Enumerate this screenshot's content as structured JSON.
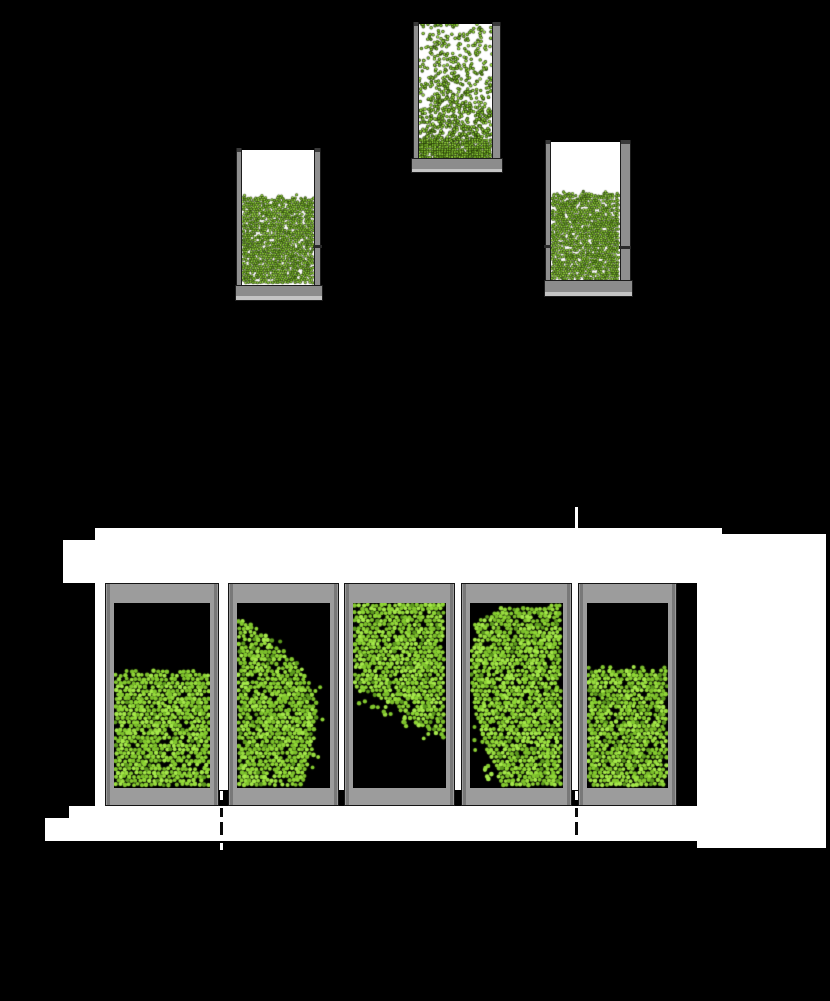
{
  "figure": {
    "background": "#000000",
    "palette": {
      "white": "#ffffff",
      "frame_gray": "#9c9c9c",
      "frame_edge": "#787878",
      "frame_line": "#141414",
      "wall_gray": "#8f8f8f",
      "slab_gray": "#8c8c8c",
      "slab_light": "#c4c4c4",
      "cap_dark": "#3a3a3a",
      "interior_black": "#000000",
      "particle_colors": [
        "#8fd636",
        "#99dd3f",
        "#a5e94a",
        "#83c92f",
        "#7cbf2b"
      ],
      "particle_dark": "#5d9a1e",
      "particle_outline": "#223407"
    },
    "top_row": [
      {
        "name": "top-left-container",
        "outer": {
          "x": 235,
          "y": 148,
          "w": 88,
          "h": 152
        },
        "walls": {
          "left": {
            "x": 236,
            "w": 6
          },
          "right": {
            "x": 314,
            "w": 7
          },
          "top_y": 148,
          "bottom_y": 285
        },
        "interior": {
          "x": 242,
          "y": 150,
          "w": 72,
          "h": 135
        },
        "slab": {
          "x": 235,
          "y": 285,
          "w": 88,
          "h": 16,
          "light_h": 4
        },
        "particles": {
          "kind": "settled",
          "top": 47,
          "seed": 11
        },
        "ticks": [
          {
            "x": 312,
            "y": 245,
            "w": 10,
            "h": 3
          }
        ]
      },
      {
        "name": "top-center-container",
        "outer": {
          "x": 411,
          "y": 22,
          "w": 92,
          "h": 151
        },
        "walls": {
          "left": {
            "x": 413,
            "w": 6
          },
          "right": {
            "x": 492,
            "w": 9
          },
          "top_y": 22,
          "bottom_y": 158
        },
        "interior": {
          "x": 419,
          "y": 24,
          "w": 73,
          "h": 134
        },
        "slab": {
          "x": 411,
          "y": 158,
          "w": 92,
          "h": 15,
          "light_h": 3
        },
        "particles": {
          "kind": "fluidized",
          "dense_band_top": 116,
          "seed": 23
        },
        "ticks": []
      },
      {
        "name": "top-right-container",
        "outer": {
          "x": 544,
          "y": 140,
          "w": 89,
          "h": 157
        },
        "walls": {
          "left": {
            "x": 545,
            "w": 6
          },
          "right": {
            "x": 620,
            "w": 11
          },
          "top_y": 140,
          "bottom_y": 280
        },
        "interior": {
          "x": 551,
          "y": 142,
          "w": 69,
          "h": 138
        },
        "slab": {
          "x": 544,
          "y": 280,
          "w": 89,
          "h": 17,
          "light_h": 4
        },
        "particles": {
          "kind": "settled",
          "top": 51,
          "seed": 37
        },
        "ticks": [
          {
            "x": 544,
            "y": 245,
            "w": 8,
            "h": 3
          },
          {
            "x": 619,
            "y": 246,
            "w": 12,
            "h": 3
          }
        ]
      }
    ],
    "white_blocks": [
      {
        "x": 95,
        "y": 528,
        "w": 627,
        "h": 12
      },
      {
        "x": 63,
        "y": 540,
        "w": 659,
        "h": 43
      },
      {
        "x": 722,
        "y": 534,
        "w": 104,
        "h": 49
      },
      {
        "x": 697,
        "y": 583,
        "w": 129,
        "h": 265
      },
      {
        "x": 95,
        "y": 583,
        "w": 10,
        "h": 223
      },
      {
        "x": 219,
        "y": 583,
        "w": 9,
        "h": 207
      },
      {
        "x": 339,
        "y": 583,
        "w": 6,
        "h": 207
      },
      {
        "x": 455,
        "y": 583,
        "w": 6,
        "h": 207
      },
      {
        "x": 572,
        "y": 583,
        "w": 6,
        "h": 207
      },
      {
        "x": 69,
        "y": 806,
        "w": 628,
        "h": 35
      },
      {
        "x": 45,
        "y": 818,
        "w": 24,
        "h": 23
      },
      {
        "x": 575,
        "y": 507,
        "w": 3,
        "h": 21
      }
    ],
    "bottom_row": [
      {
        "name": "bottom-container-1",
        "outer": {
          "x": 105,
          "y": 583,
          "w": 114,
          "h": 223
        },
        "frame": {
          "side_w": 9,
          "top_h": 20,
          "bottom_h": 18
        },
        "interior": {
          "x": 114,
          "y": 603,
          "w": 96,
          "h": 185
        },
        "particles": {
          "kind": "flat",
          "top": 68,
          "seed": 51
        }
      },
      {
        "name": "bottom-container-2",
        "outer": {
          "x": 228,
          "y": 583,
          "w": 111,
          "h": 223
        },
        "frame": {
          "side_w": 9,
          "top_h": 20,
          "bottom_h": 18
        },
        "interior": {
          "x": 237,
          "y": 603,
          "w": 93,
          "h": 185
        },
        "particles": {
          "kind": "left-blob",
          "seed": 67,
          "boundary": [
            [
              14,
              0
            ],
            [
              29,
              28
            ],
            [
              54,
              53
            ],
            [
              80,
              73
            ],
            [
              102,
              81
            ],
            [
              136,
              78
            ],
            [
              166,
              69
            ],
            [
              185,
              66
            ]
          ]
        }
      },
      {
        "name": "bottom-container-3",
        "outer": {
          "x": 344,
          "y": 583,
          "w": 111,
          "h": 223
        },
        "frame": {
          "side_w": 9,
          "top_h": 20,
          "bottom_h": 18
        },
        "interior": {
          "x": 353,
          "y": 603,
          "w": 93,
          "h": 185
        },
        "particles": {
          "kind": "top-wedge",
          "seed": 83,
          "boundary": [
            [
              0,
              86
            ],
            [
              27,
              96
            ],
            [
              47,
              108
            ],
            [
              67,
              124
            ],
            [
              93,
              138
            ]
          ]
        }
      },
      {
        "name": "bottom-container-4",
        "outer": {
          "x": 461,
          "y": 583,
          "w": 111,
          "h": 223
        },
        "frame": {
          "side_w": 9,
          "top_h": 20,
          "bottom_h": 18
        },
        "interior": {
          "x": 470,
          "y": 603,
          "w": 93,
          "h": 185
        },
        "particles": {
          "kind": "right-blob",
          "seed": 97,
          "boundary": [
            [
              19,
              5
            ],
            [
              62,
              0
            ],
            [
              102,
              3
            ],
            [
              142,
              13
            ],
            [
              172,
              27
            ],
            [
              185,
              35
            ]
          ],
          "top_profile": [
            [
              5,
              19
            ],
            [
              35,
              3
            ],
            [
              93,
              2
            ]
          ]
        }
      },
      {
        "name": "bottom-container-5",
        "outer": {
          "x": 578,
          "y": 583,
          "w": 99,
          "h": 223
        },
        "frame": {
          "side_w": 9,
          "top_h": 20,
          "bottom_h": 18
        },
        "interior": {
          "x": 587,
          "y": 603,
          "w": 81,
          "h": 185
        },
        "particles": {
          "kind": "flat",
          "top": 65,
          "seed": 113
        }
      }
    ],
    "dashes_white": [
      {
        "x": 220,
        "y": 791,
        "w": 3,
        "h": 9
      },
      {
        "x": 575,
        "y": 791,
        "w": 3,
        "h": 9
      },
      {
        "x": 220,
        "y": 843,
        "w": 3,
        "h": 7
      }
    ],
    "dashes_black": [
      {
        "x": 220,
        "y": 808,
        "w": 3,
        "h": 9
      },
      {
        "x": 220,
        "y": 822,
        "w": 3,
        "h": 13
      },
      {
        "x": 575,
        "y": 808,
        "w": 3,
        "h": 9
      },
      {
        "x": 575,
        "y": 822,
        "w": 3,
        "h": 13
      }
    ]
  }
}
